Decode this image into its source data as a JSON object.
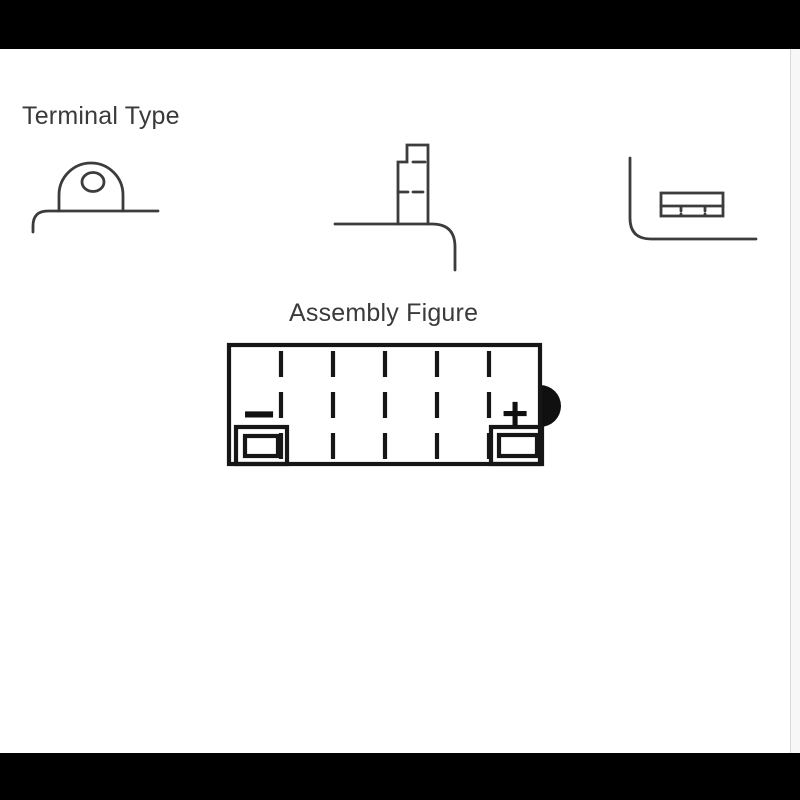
{
  "page": {
    "background_color": "#ffffff",
    "top_bar_color": "#000000",
    "bottom_bar_color": "#000000",
    "right_border_color": "#d9d9d9"
  },
  "terminal_section": {
    "title": "Terminal Type",
    "styles": [
      "round-tab-with-hole",
      "vertical-post",
      "flat-block"
    ]
  },
  "assembly_section": {
    "title": "Assembly Figure",
    "negative_label": "−",
    "positive_label": "+",
    "cell_count": 6
  },
  "colors": {
    "terminal_line": "#3c3c3c",
    "assembly_line": "#161616"
  }
}
